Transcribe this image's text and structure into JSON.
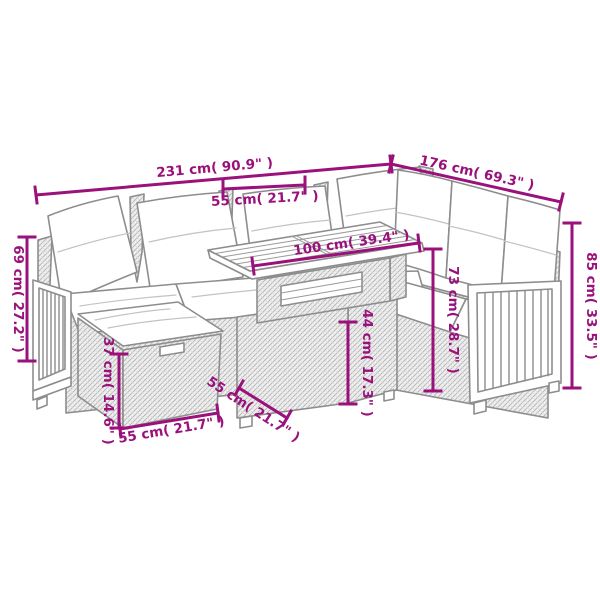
{
  "diagram": {
    "type": "product-dimension-drawing",
    "colors": {
      "dimension_accent": "#9a117c",
      "line_art": "#8d8d8d",
      "background": "#ffffff"
    },
    "dimensions": [
      {
        "id": "total-width-left",
        "label": "231 cm( 90.9\" )"
      },
      {
        "id": "total-width-right",
        "label": "176 cm( 69.3\" )"
      },
      {
        "id": "seat-width-top",
        "label": "55 cm( 21.7\" )"
      },
      {
        "id": "table-top-length",
        "label": "100 cm( 39.4\" )"
      },
      {
        "id": "sofa-height-left",
        "label": "69 cm( 27.2\" )"
      },
      {
        "id": "sofa-back-height-right",
        "label": "85 cm( 33.5\" )"
      },
      {
        "id": "table-height",
        "label": "73 cm( 28.7\" )"
      },
      {
        "id": "table-base-height",
        "label": "44 cm( 17.3\" )"
      },
      {
        "id": "ottoman-height",
        "label": "37 cm( 14.6\" )"
      },
      {
        "id": "ottoman-width",
        "label": "55 cm( 21.7\" )"
      },
      {
        "id": "table-depth",
        "label": "55 cm( 21.7\" )"
      }
    ]
  }
}
